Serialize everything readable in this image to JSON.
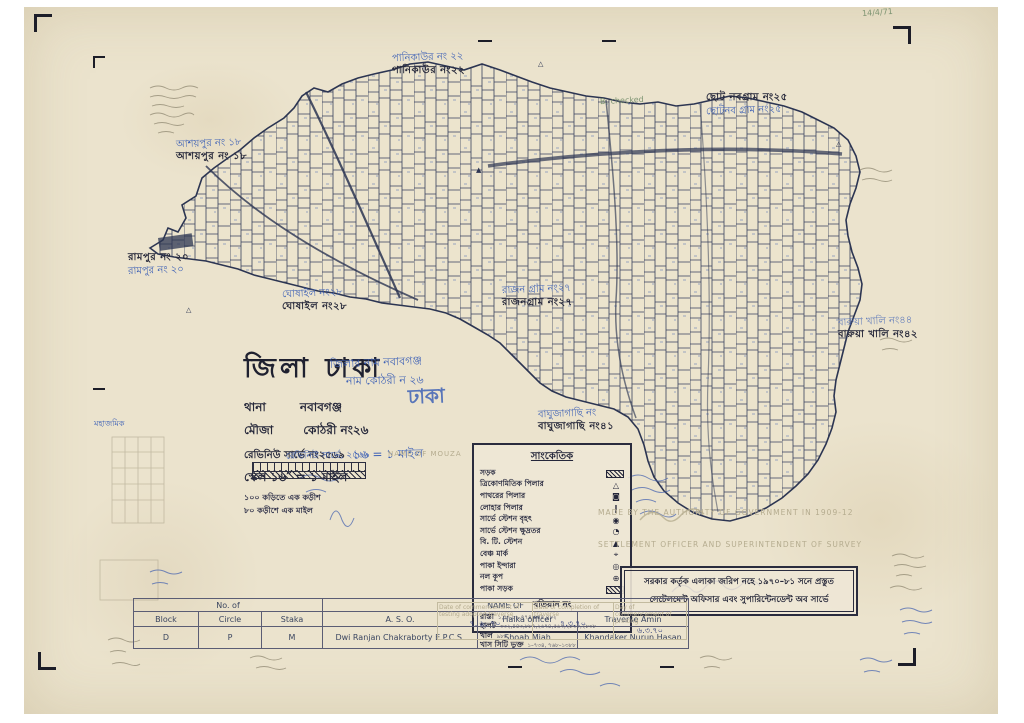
{
  "colors": {
    "paper": "#ebe3cd",
    "ink": "#26283a",
    "map_ink": "#39415e",
    "blue_pen": "#3f62b6",
    "pencil": "#8d8672",
    "faint": "#b5ac8f"
  },
  "neighbors": {
    "panikaur": {
      "hand": "পানিকাউর নং ২২",
      "printed": "পানিকাউর নং২২"
    },
    "chhoto_nabagram": {
      "printed": "ছোট নবগ্রাম নং২৫",
      "hand": "ছোটনব গ্রাম নং২৫"
    },
    "ashaypur": {
      "hand": "আশয়পুর নং ১৮",
      "printed": "আশয়পুর নং ১৮"
    },
    "rampur": {
      "printed": "রামপুর নং ২০",
      "hand": "রামপুর নং ২০"
    },
    "ghoshail": {
      "hand": "ঘোষাইল নং২৮",
      "printed": "ঘোষাইল নং২৮"
    },
    "rajnagram": {
      "hand": "রাজন গ্রাম নং২৭",
      "printed": "রাজনগ্রাম নং২৭"
    },
    "barua_khali": {
      "hand": "বারুয়া খালি নং৪৪",
      "printed": "বারুয়া খালি নং৪২"
    },
    "baghujagachhi": {
      "hand": "বাঘুজাগাছি নং",
      "printed": "বাঘুজাগাছি নং৪১"
    }
  },
  "title_block": {
    "district": "জিলা ঢাকা",
    "hand_note_1": "জিলার নাম নবাবগঞ্জ",
    "hand_note_2": "নাম কোঠরী ন ২৬",
    "thana_label": "থানা",
    "thana_value": "নবাবগঞ্জ",
    "mouza_label": "মৌজা",
    "mouza_value": "কোঠরী নং২৬",
    "hand_overwrite": "ঢাকা",
    "survey_line": "রেভিনিউ সার্ভে নং২৫৬৯",
    "hand_scale": "১৬ = ১ মাইল",
    "scale_line": "স্কেল ১৬″ = ১ মাইল",
    "sub_line_1": "১০০ কড়িতে এক কড়ীশ",
    "sub_line_2": "৮০ কড়ীশে এক মাইল",
    "hand_survey": "রেভিনিউ সার্ভে, ২৫৬৯"
  },
  "legend": {
    "title": "সাংকেতিক",
    "items": [
      {
        "label": "সড়ক",
        "symbol": "",
        "hatch": true,
        "icon": "road-hatch-icon"
      },
      {
        "label": "ত্রিকোণমিতিক পিলার",
        "symbol": "△",
        "icon": "trig-pillar-icon"
      },
      {
        "label": "পাথরের পিলার",
        "symbol": "◙",
        "icon": "stone-pillar-icon"
      },
      {
        "label": "লোহার পিলার",
        "symbol": "❙",
        "icon": "iron-pillar-icon"
      },
      {
        "label": "সার্ভে স্টেশন বৃহৎ",
        "symbol": "◉",
        "icon": "survey-station-large-icon"
      },
      {
        "label": "সার্ভে স্টেশন ক্ষুদ্রতর",
        "symbol": "◔",
        "icon": "survey-station-small-icon"
      },
      {
        "label": "বি. টি. স্টেশন",
        "symbol": "▲",
        "icon": "bt-station-icon"
      },
      {
        "label": "বেঞ্চ মার্ক",
        "symbol": "⌖",
        "icon": "bench-mark-icon"
      },
      {
        "label": "পাকা ইন্দারা",
        "symbol": "◎",
        "icon": "well-icon"
      },
      {
        "label": "নল কূপ",
        "symbol": "⊕",
        "icon": "tube-well-icon"
      },
      {
        "label": "পাকা সড়ক",
        "symbol": "",
        "hatch": true,
        "icon": "paved-road-hatch-icon"
      }
    ],
    "khatian_title": "খতিয়ান নং",
    "khatian_rows": [
      {
        "label": "রাস্তা",
        "numbers": "১,৭৭,৮৯,৭৭৪,৪৪৫,৪৮২"
      },
      {
        "label": "হালট",
        "numbers": "৩৩২,৪৪৩,৮৮৭,২৬৭৪,৫৬৭,২৮৩০,২৮৩৮"
      },
      {
        "label": "খাল",
        "numbers": "৯৮৮"
      },
      {
        "label": "খাস সিটি ভুক্ত",
        "numbers": "১–৭৩৪, ৭৬৮–১৩৮৮"
      }
    ]
  },
  "faint_stamp": {
    "line1": "MADE BY THE AUTHORITY OF GOVERNMENT IN 1909-12",
    "line2": "SETTLEMENT OFFICER AND SUPERINTENDENT OF SURVEY"
  },
  "stamp_box": {
    "line1": "সরকার কর্তৃক এলাকা জরিপ নহে ১৯৭০–৮১ সনে প্রস্তুত",
    "line2": "সেটেলমেন্ট অফিসার এবং সুপারিন্টেনডেন্ট অব সার্ভে"
  },
  "bottom_table": {
    "group1": "No. of",
    "group2": "NAME OF",
    "headers": [
      "Block",
      "Circle",
      "Staka",
      "A. S. O.",
      "Halka officer",
      "Traverse Amin"
    ],
    "row": [
      "D",
      "P",
      "M",
      "Dwi Ranjan Chakraborty E.P.C.S.",
      "Shoab Miah",
      "Khandaker Nurun Hasan"
    ]
  },
  "dates_row": {
    "h1": "Date of commencement of testing adopted traverse",
    "h2": "Date of completion of traverse",
    "h3": "Day of commencement of printing",
    "v1": "৭. ৯. ৭০",
    "v2": "৭.৩.৭০",
    "v3": "৬.৩.৭০"
  },
  "annotations": {
    "green_check": "B. checked",
    "green_date": "14/4/71",
    "left_blue_small": "মহাজমিক",
    "name_of_mouza_faint": "NAME OF MOUZA"
  }
}
